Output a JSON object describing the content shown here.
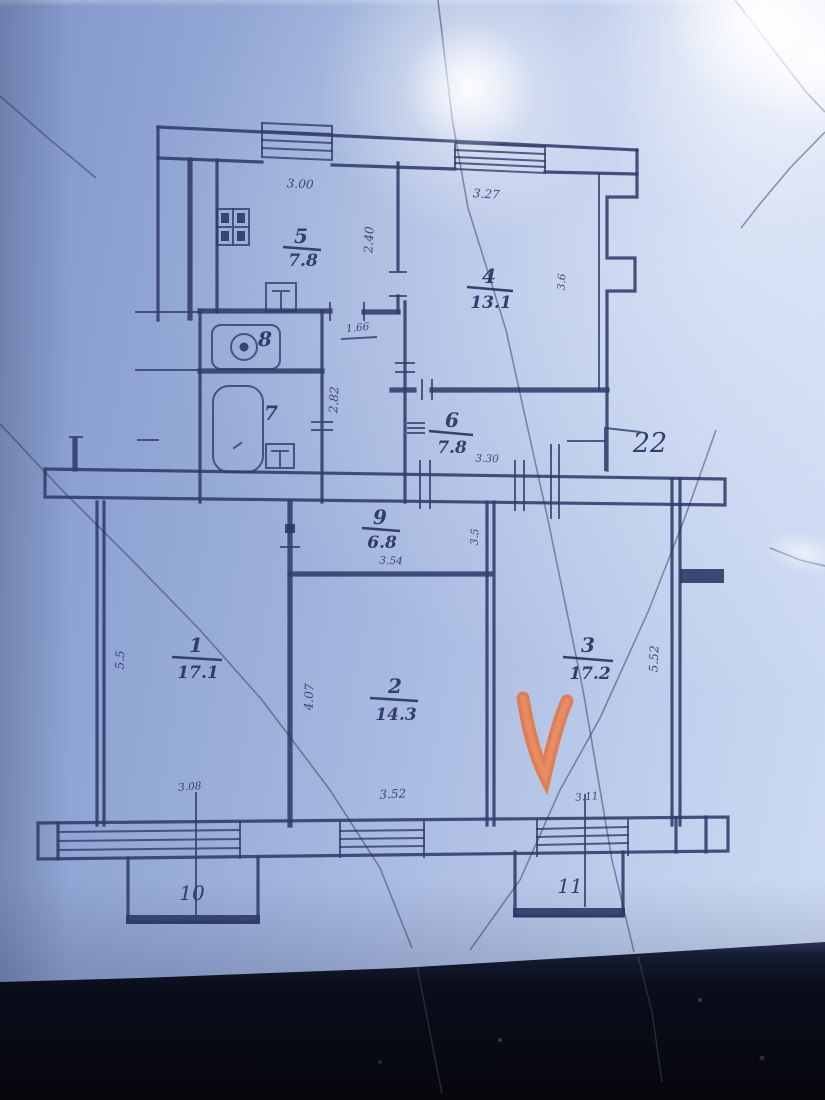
{
  "plan": {
    "line_color": "#303c6b",
    "rooms": {
      "kitchen": {
        "num": "5",
        "area": "7.8"
      },
      "room4": {
        "num": "4",
        "area": "13.1"
      },
      "wc": {
        "num": "8"
      },
      "bath": {
        "num": "7"
      },
      "hall6": {
        "num": "6",
        "area": "7.8"
      },
      "hall9": {
        "num": "9",
        "area": "6.8"
      },
      "room1": {
        "num": "1",
        "area": "17.1"
      },
      "room2": {
        "num": "2",
        "area": "14.3"
      },
      "room3": {
        "num": "3",
        "area": "17.2"
      },
      "loggia22": {
        "num": "22"
      },
      "balcony10": {
        "num": "10"
      },
      "balcony11": {
        "num": "11"
      }
    },
    "dims": {
      "kitchen_w": "3.00",
      "room4_w": "3.27",
      "kitchen_h": "2.40",
      "room4_h": "3.6",
      "hall_w": "1.66",
      "bath_h": "2.82",
      "hall6_w": "3.30",
      "hall9_w": "3.54",
      "hall9_h": "3.5",
      "room1_h": "5.5",
      "room2_h": "4.07",
      "room3_h": "5.52",
      "room1_win": "3.08",
      "room2_win": "3.52",
      "room3_win": "3.11"
    },
    "annotation": {
      "checkmark_color": "#e2774a"
    }
  }
}
